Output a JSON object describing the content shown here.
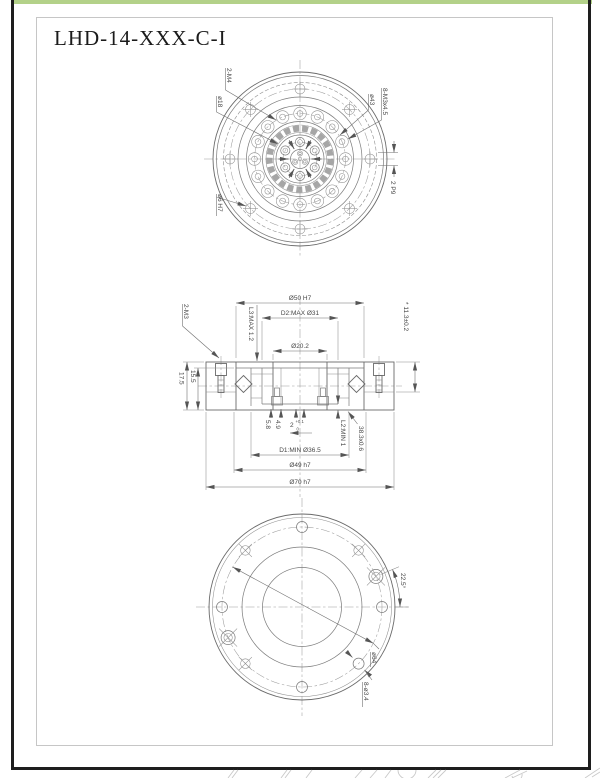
{
  "page": {
    "title": "LHD-14-XXX-C-I"
  },
  "front_view": {
    "label_2m4": "2-M4",
    "label_d18": "ø18",
    "label_d43": "ø43",
    "label_8m3": "8-M3x4.5",
    "label_key": "2 P9",
    "label_d6": "ø6 H7"
  },
  "section_view": {
    "dim_d50": "Ø50 H7",
    "dim_d2": "D2:MAX Ø31",
    "dim_d202": "Ø20.2",
    "label_2m3": "2-M3",
    "dim_l3": "L3:MAX 1.2",
    "dim_113": "* 11.3±0.2",
    "dim_175": "17.5",
    "dim_155": "15.5",
    "dim_58": "5.8",
    "dim_49": "4.9",
    "dim_key": "2",
    "dim_key_hi": "+0.1",
    "dim_key_lo": "0",
    "dim_d1": "D1:MIN Ø36.5",
    "dim_d49": "Ø49 h7",
    "dim_d70": "Ø70 h7",
    "dim_l2": "L2:MIN 1",
    "label_ring": "38.3x0.6"
  },
  "back_view": {
    "label_d64": "ø64",
    "label_holes": "8-ø3.4",
    "label_angle": "22.5°"
  },
  "colors": {
    "accent_green": "#b3d189",
    "page_border": "#1e1e1e",
    "line": "#6a6a6a",
    "dim_text": "#474747"
  }
}
